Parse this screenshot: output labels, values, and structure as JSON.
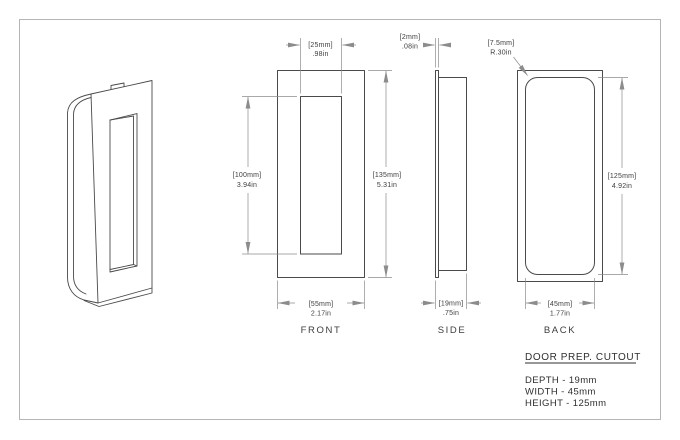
{
  "colors": {
    "background": "#ffffff",
    "sheet_border": "#b5b5b5",
    "part_line": "#4a4a4a",
    "dimension_line": "#8c8c8c",
    "text": "#3d3d3d"
  },
  "views": {
    "front": {
      "label": "FRONT",
      "recess_width": {
        "mm": "[25mm]",
        "in": ".98in"
      },
      "recess_height": {
        "mm": "[100mm]",
        "in": "3.94in"
      },
      "height": {
        "mm": "[135mm]",
        "in": "5.31in"
      },
      "width": {
        "mm": "[55mm]",
        "in": "2.17in"
      }
    },
    "side": {
      "label": "SIDE",
      "flange": {
        "mm": "[2mm]",
        "in": ".08in"
      },
      "depth": {
        "mm": "[19mm]",
        "in": ".75in"
      }
    },
    "back": {
      "label": "BACK",
      "corner_radius": {
        "mm": "[7.5mm]",
        "in": "R.30in"
      },
      "height": {
        "mm": "[125mm]",
        "in": "4.92in"
      },
      "width": {
        "mm": "[45mm]",
        "in": "1.77in"
      }
    }
  },
  "notes": {
    "title": "DOOR PREP. CUTOUT",
    "lines": [
      "DEPTH - 19mm",
      "WIDTH - 45mm",
      "HEIGHT - 125mm"
    ]
  }
}
